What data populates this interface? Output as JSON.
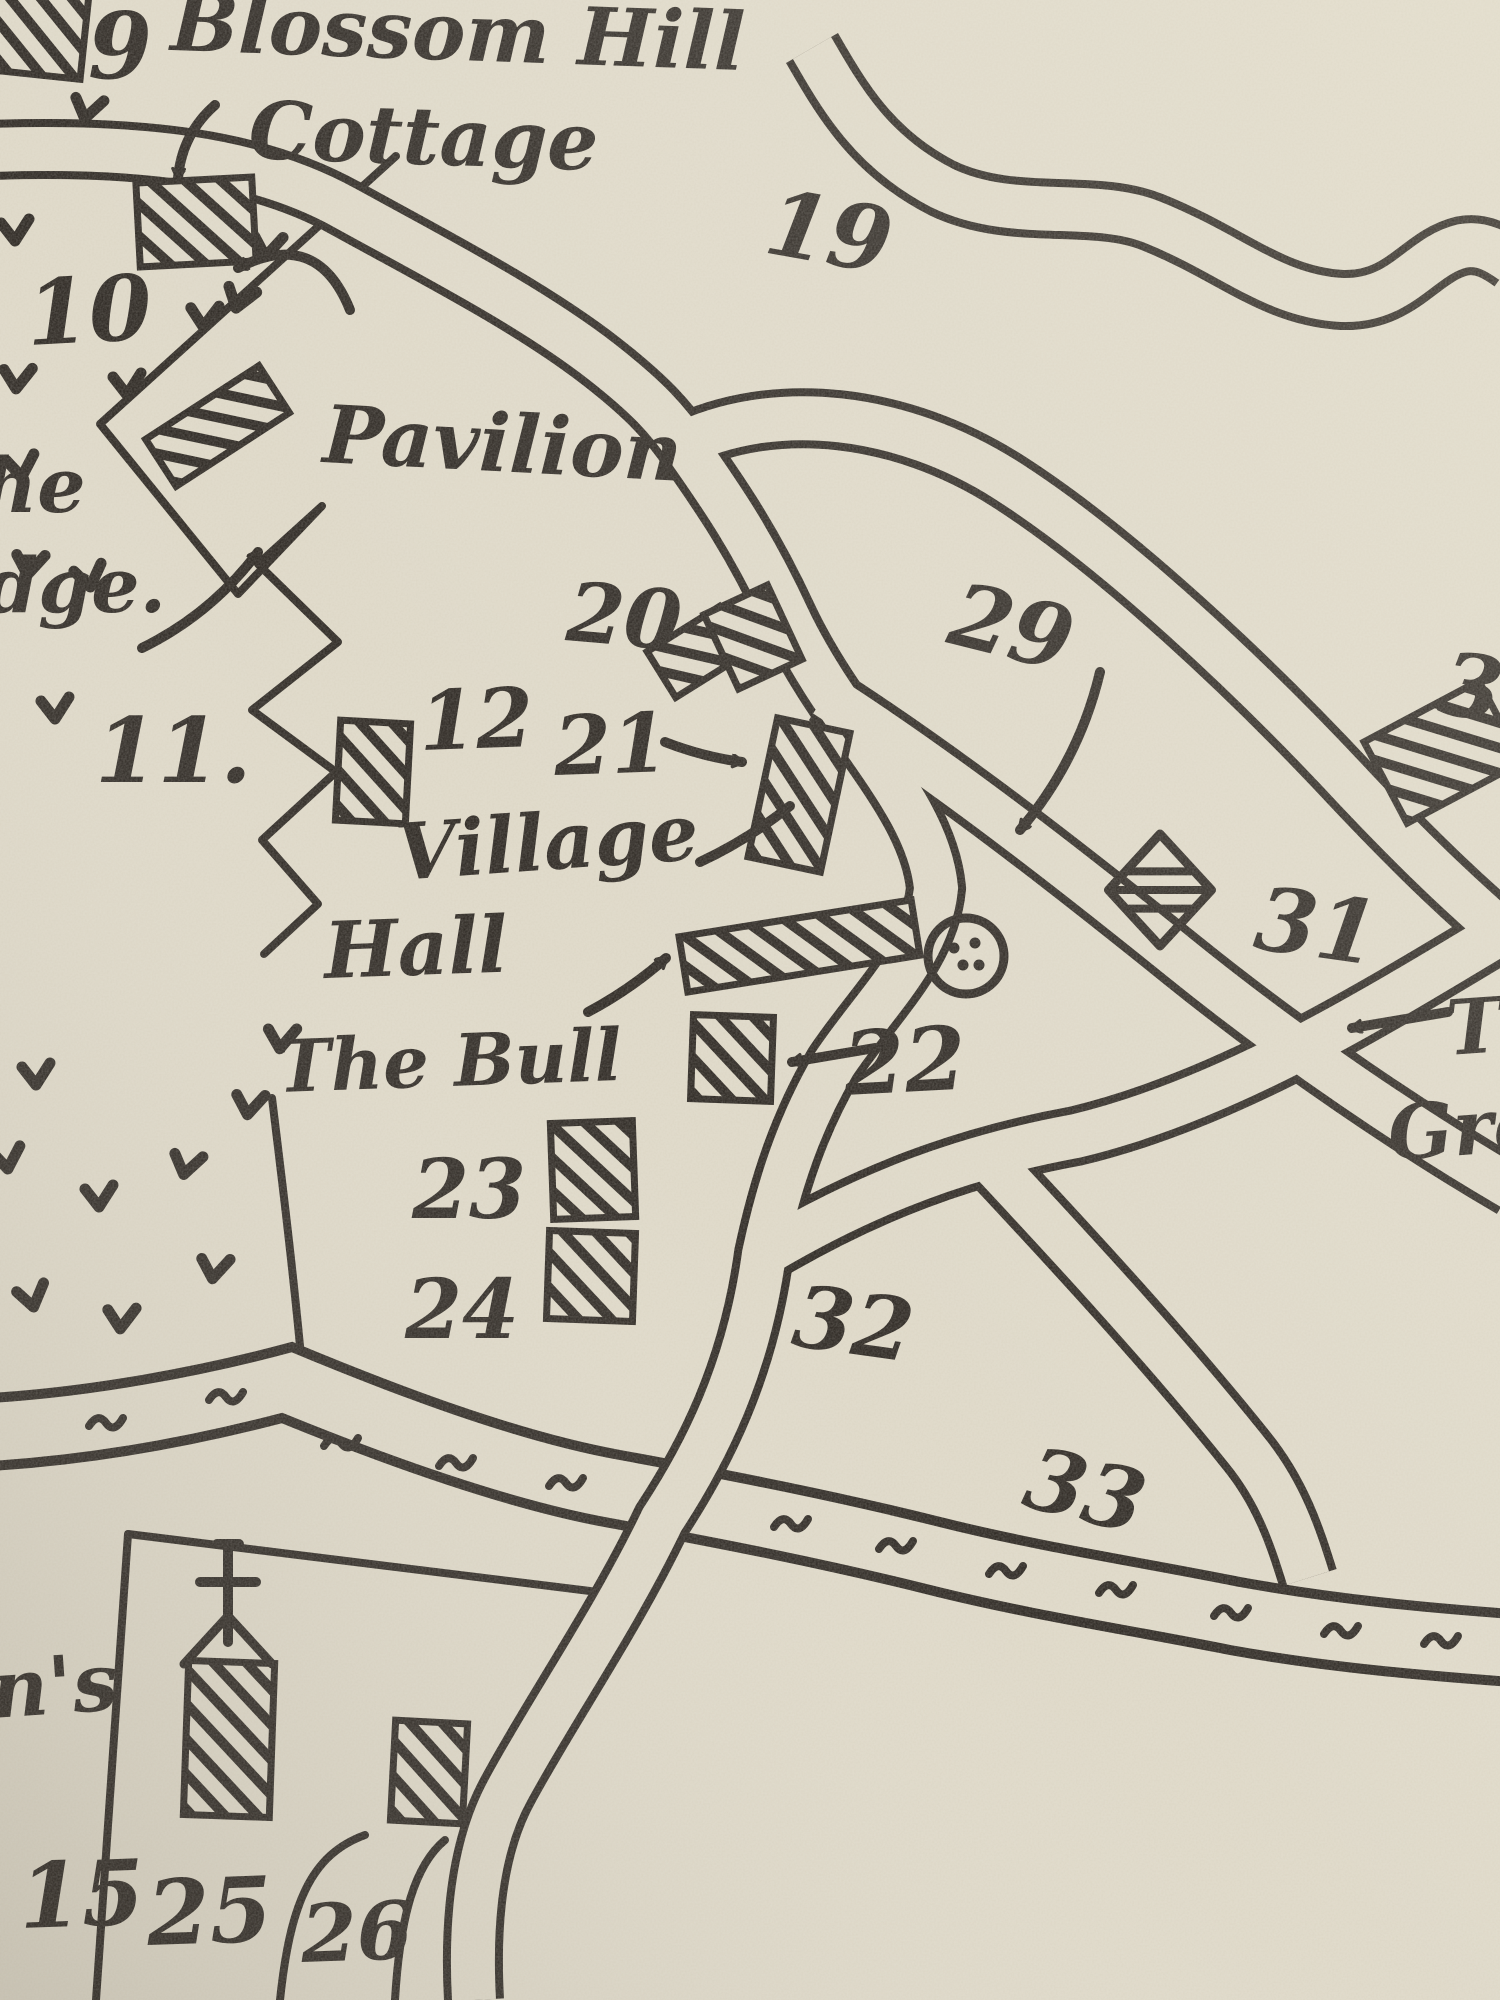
{
  "map": {
    "ink_color": "#26211c",
    "paper_color": "#dcd6c5",
    "labels": [
      {
        "id": "plot-9",
        "text": "9",
        "x": 88,
        "y": 78,
        "size": 92,
        "rot": 0
      },
      {
        "id": "blossom-hill",
        "text": "Blossom Hill",
        "x": 170,
        "y": 50,
        "size": 80,
        "rot": 2
      },
      {
        "id": "cottage",
        "text": "Cottage",
        "x": 248,
        "y": 158,
        "size": 80,
        "rot": 2
      },
      {
        "id": "plot-19",
        "text": "19",
        "x": 762,
        "y": 252,
        "size": 90,
        "rot": 10
      },
      {
        "id": "plot-10",
        "text": "10",
        "x": 28,
        "y": 345,
        "size": 90,
        "rot": -3
      },
      {
        "id": "the-partial",
        "text": "he",
        "x": -18,
        "y": 512,
        "size": 76,
        "rot": 0
      },
      {
        "id": "lodge-partial",
        "text": "dge.",
        "x": -15,
        "y": 612,
        "size": 76,
        "rot": 0
      },
      {
        "id": "plot-11",
        "text": "11.",
        "x": 95,
        "y": 782,
        "size": 90,
        "rot": 0
      },
      {
        "id": "pavilion",
        "text": "Pavilion",
        "x": 322,
        "y": 462,
        "size": 80,
        "rot": 3
      },
      {
        "id": "plot-20",
        "text": "20",
        "x": 565,
        "y": 640,
        "size": 82,
        "rot": 5
      },
      {
        "id": "plot-12",
        "text": "12",
        "x": 420,
        "y": 750,
        "size": 82,
        "rot": -2
      },
      {
        "id": "plot-21",
        "text": "21",
        "x": 555,
        "y": 775,
        "size": 82,
        "rot": -2
      },
      {
        "id": "village",
        "text": "Village",
        "x": 398,
        "y": 880,
        "size": 78,
        "rot": -4
      },
      {
        "id": "hall",
        "text": "Hall",
        "x": 325,
        "y": 978,
        "size": 78,
        "rot": -2
      },
      {
        "id": "the-bull",
        "text": "The Bull",
        "x": 278,
        "y": 1092,
        "size": 72,
        "rot": -2
      },
      {
        "id": "plot-22",
        "text": "22",
        "x": 845,
        "y": 1095,
        "size": 88,
        "rot": -3
      },
      {
        "id": "plot-23",
        "text": "23",
        "x": 412,
        "y": 1218,
        "size": 82,
        "rot": 0
      },
      {
        "id": "plot-24",
        "text": "24",
        "x": 405,
        "y": 1338,
        "size": 82,
        "rot": 0
      },
      {
        "id": "plot-29",
        "text": "29",
        "x": 945,
        "y": 642,
        "size": 88,
        "rot": 14
      },
      {
        "id": "plot-31",
        "text": "31",
        "x": 1252,
        "y": 948,
        "size": 88,
        "rot": 8
      },
      {
        "id": "plot-30-partial",
        "text": "3",
        "x": 1436,
        "y": 712,
        "size": 88,
        "rot": 10
      },
      {
        "id": "plot-32",
        "text": "32",
        "x": 790,
        "y": 1345,
        "size": 86,
        "rot": 8
      },
      {
        "id": "plot-33",
        "text": "33",
        "x": 1020,
        "y": 1505,
        "size": 86,
        "rot": 14
      },
      {
        "id": "the-green-line1",
        "text": "Th",
        "x": 1448,
        "y": 1055,
        "size": 76,
        "rot": -4
      },
      {
        "id": "the-green-line2",
        "text": "Gree",
        "x": 1390,
        "y": 1160,
        "size": 76,
        "rot": -4
      },
      {
        "id": "stephens-partial",
        "text": "n's",
        "x": -8,
        "y": 1718,
        "size": 80,
        "rot": -4
      },
      {
        "id": "plot-15",
        "text": "15",
        "x": 20,
        "y": 1928,
        "size": 90,
        "rot": -2
      },
      {
        "id": "plot-25",
        "text": "25",
        "x": 148,
        "y": 1945,
        "size": 90,
        "rot": -2
      },
      {
        "id": "plot-26",
        "text": "26",
        "x": 302,
        "y": 1962,
        "size": 80,
        "rot": -2
      }
    ],
    "buildings": [
      {
        "id": "building-9",
        "x": -40,
        "y": -15,
        "w": 125,
        "h": 88,
        "rot": 6
      },
      {
        "id": "building-blossom-hill-cottage",
        "x": 138,
        "y": 180,
        "w": 116,
        "h": 84,
        "rot": -3
      },
      {
        "id": "building-pavilion",
        "x": 150,
        "y": 398,
        "w": 135,
        "h": 56,
        "rot": -33
      },
      {
        "id": "building-12",
        "x": 338,
        "y": 722,
        "w": 70,
        "h": 100,
        "rot": 3
      },
      {
        "id": "building-20a",
        "x": 655,
        "y": 625,
        "w": 85,
        "h": 54,
        "rot": -32
      },
      {
        "id": "building-20b",
        "x": 718,
        "y": 596,
        "w": 70,
        "h": 82,
        "rot": -25
      },
      {
        "id": "building-21",
        "x": 762,
        "y": 724,
        "w": 74,
        "h": 142,
        "rot": 12
      },
      {
        "id": "building-village-hall",
        "x": 682,
        "y": 918,
        "w": 235,
        "h": 56,
        "rot": -9
      },
      {
        "id": "building-the-bull",
        "x": 692,
        "y": 1016,
        "w": 80,
        "h": 84,
        "rot": 2
      },
      {
        "id": "building-23",
        "x": 552,
        "y": 1122,
        "w": 82,
        "h": 96,
        "rot": -2
      },
      {
        "id": "building-24",
        "x": 548,
        "y": 1232,
        "w": 86,
        "h": 88,
        "rot": 2
      },
      {
        "id": "building-26",
        "x": 393,
        "y": 1722,
        "w": 72,
        "h": 100,
        "rot": 3
      },
      {
        "id": "building-church",
        "x": 186,
        "y": 1662,
        "w": 86,
        "h": 154,
        "rot": 2
      },
      {
        "id": "building-top-right",
        "x": 1378,
        "y": 706,
        "w": 130,
        "h": 92,
        "rot": -28
      }
    ],
    "symbols": [
      {
        "id": "pond",
        "type": "pond",
        "x": 966,
        "y": 956,
        "r": 38
      },
      {
        "id": "site-31-diamond",
        "type": "diamond",
        "x": 1160,
        "y": 890,
        "r": 56
      },
      {
        "id": "church-cross",
        "type": "cross",
        "x": 228,
        "y": 1640
      },
      {
        "id": "church-roof",
        "type": "roof",
        "x": 228,
        "y": 1664
      }
    ],
    "arrows": [
      {
        "id": "arrow-cottage",
        "x1": 215,
        "y1": 105,
        "x2": 178,
        "y2": 178,
        "bend": 20
      },
      {
        "id": "arrow-pavilion",
        "x1": 350,
        "y1": 310,
        "x2": 238,
        "y2": 268,
        "bend": 55
      },
      {
        "id": "arrow-lodge",
        "x1": 142,
        "y1": 648,
        "x2": 258,
        "y2": 552,
        "bend": 12
      },
      {
        "id": "arrow-21",
        "x1": 665,
        "y1": 742,
        "x2": 742,
        "y2": 762,
        "bend": 6
      },
      {
        "id": "arrow-village",
        "x1": 700,
        "y1": 862,
        "x2": 790,
        "y2": 806,
        "bend": 6
      },
      {
        "id": "arrow-village-hall",
        "x1": 588,
        "y1": 1012,
        "x2": 666,
        "y2": 958,
        "bend": 6
      },
      {
        "id": "arrow-22",
        "x1": 875,
        "y1": 1048,
        "x2": 792,
        "y2": 1062,
        "bend": 0
      },
      {
        "id": "arrow-29",
        "x1": 1100,
        "y1": 672,
        "x2": 1020,
        "y2": 830,
        "bend": -12
      },
      {
        "id": "arrow-the-green",
        "x1": 1448,
        "y1": 1012,
        "x2": 1352,
        "y2": 1028,
        "bend": 0
      }
    ],
    "v_marks": [
      [
        12,
        60,
        -10
      ],
      [
        88,
        110,
        15
      ],
      [
        16,
        232,
        0
      ],
      [
        268,
        248,
        10
      ],
      [
        290,
        196,
        -15
      ],
      [
        205,
        318,
        5
      ],
      [
        128,
        386,
        0
      ],
      [
        240,
        300,
        20
      ],
      [
        18,
        380,
        6
      ],
      [
        22,
        468,
        -5
      ],
      [
        30,
        566,
        10
      ],
      [
        90,
        578,
        -8
      ],
      [
        56,
        710,
        0
      ],
      [
        282,
        1040,
        8
      ],
      [
        37,
        1076,
        0
      ],
      [
        250,
        1106,
        10
      ],
      [
        8,
        1160,
        -5
      ],
      [
        187,
        1166,
        15
      ],
      [
        100,
        1198,
        0
      ],
      [
        215,
        1270,
        10
      ],
      [
        33,
        1298,
        -10
      ],
      [
        122,
        1320,
        5
      ]
    ],
    "river_dashes": [
      [
        115,
        1422
      ],
      [
        235,
        1396
      ],
      [
        350,
        1442
      ],
      [
        465,
        1462
      ],
      [
        575,
        1482
      ],
      [
        800,
        1523
      ],
      [
        905,
        1545
      ],
      [
        1015,
        1570
      ],
      [
        1125,
        1589
      ],
      [
        1240,
        1612
      ],
      [
        1350,
        1630
      ],
      [
        1450,
        1640
      ]
    ]
  }
}
